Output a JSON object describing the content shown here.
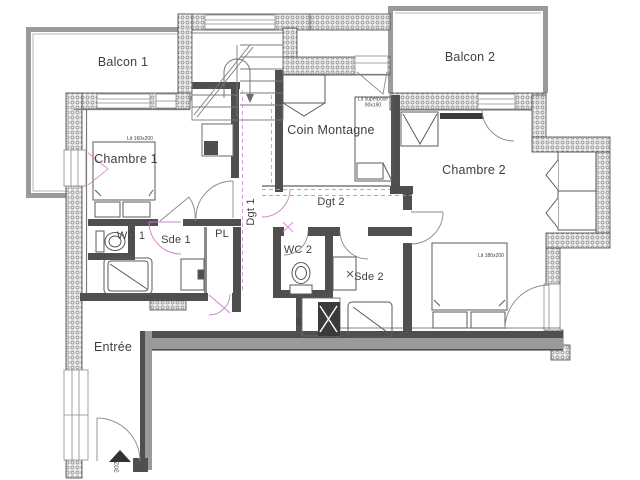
{
  "plan": {
    "unit_number": "302",
    "rooms": {
      "balcon1": "Balcon 1",
      "balcon2": "Balcon 2",
      "chambre1": "Chambre 1",
      "chambre2": "Chambre 2",
      "coin_montagne": "Coin Montagne",
      "wc1": "WC 1",
      "sde1": "Sde 1",
      "wc2": "WC 2",
      "sde2": "Sde 2",
      "pl": "PL",
      "dgt1": "Dgt 1",
      "dgt2": "Dgt 2",
      "ml": "ML",
      "entree": "Entrée"
    },
    "furniture": {
      "lit_chambre1": "Lit 160x200",
      "lit_chambre2": "Lit 180x200",
      "lit_superpose_l1": "Lit superposé",
      "lit_superpose_l2": "90x190"
    },
    "colors": {
      "wall_dark": "#4f4f4f",
      "wall_medium": "#9a9a9a",
      "insulation_fill": "#ececec",
      "accent_pink": "#d478d4",
      "line": "#6b6b6b",
      "text": "#3f3f3f",
      "background": "#ffffff"
    }
  }
}
